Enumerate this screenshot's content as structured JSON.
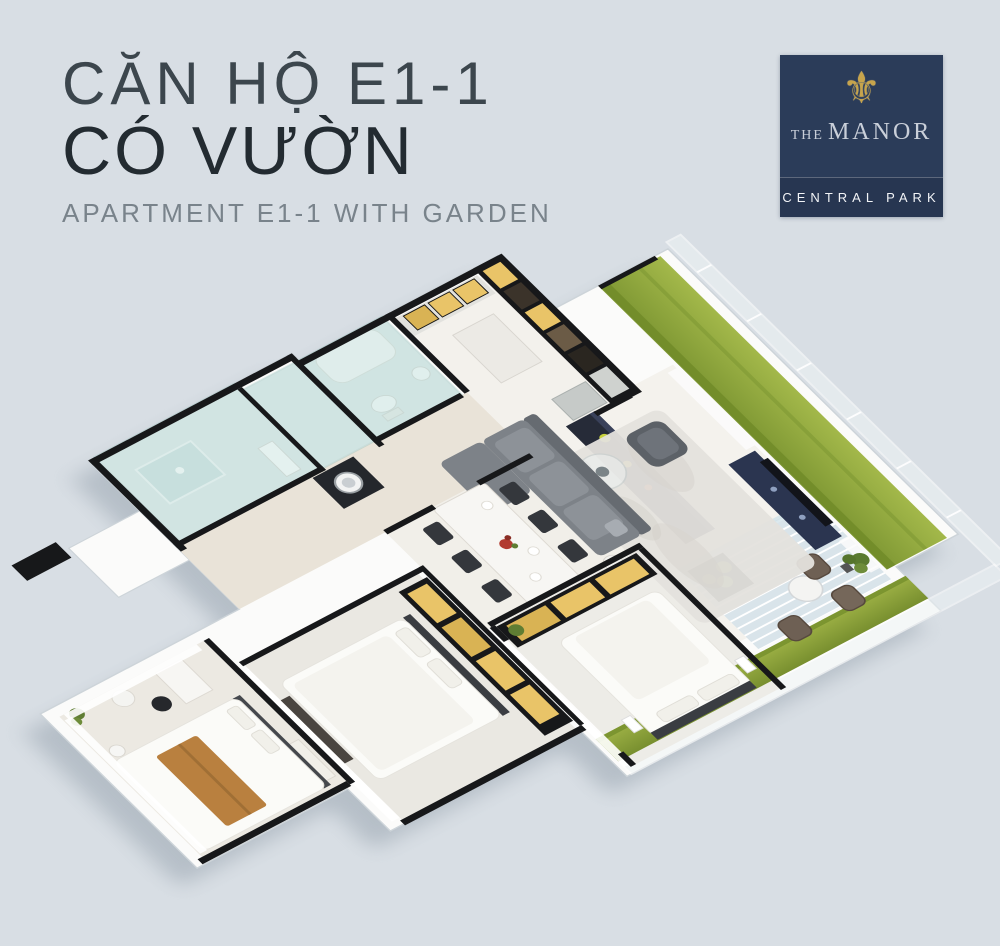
{
  "page": {
    "background": "#d8dee4",
    "width": 1000,
    "height": 946
  },
  "header": {
    "title_line1": "CĂN HỘ E1-1",
    "title_line2": "CÓ VƯỜN",
    "subtitle": "APARTMENT E1-1 WITH GARDEN",
    "colors": {
      "line1": "#3c464d",
      "line2": "#232b31",
      "subtitle": "#79838b"
    }
  },
  "logo": {
    "name_prefix": "THE",
    "name": "MANOR",
    "tagline": "CENTRAL PARK",
    "ornament": "⚜",
    "colors": {
      "background": "#2b3c59",
      "band": "#273651",
      "gold": "#c7a44c",
      "name_text": "#c9cfd9",
      "tagline_text": "#f2f4f7"
    }
  },
  "floor_plan": {
    "description": "3D isometric cutaway rendering of apartment E1-1 with wrap-around garden terrace",
    "areas": [
      "garden-strip",
      "terrace-deck",
      "kitchen",
      "bar-counter",
      "living-room",
      "dining-area",
      "corridor",
      "bathroom-1",
      "bathroom-2",
      "laundry",
      "bedroom-3",
      "bedroom-2",
      "master-bedroom",
      "entry"
    ],
    "colors": {
      "slab_white": "#fbfbfa",
      "slab_edge": "#cdd4d9",
      "wall_dark": "#17181a",
      "grass_light": "#a3b84a",
      "grass_dark": "#7e9733",
      "deck": "#d9e4ea",
      "floor_main": "#f4f2ed",
      "floor_warm": "#e9e3d8",
      "floor_bedroom": "#ece9e2",
      "glass_teal": "#a8d2cd",
      "navy": "#2b3550",
      "sofa_gray": "#7d8288",
      "rug": "#e4e2dd",
      "cabinet_yellow": "#e9c468",
      "bed_white": "#fbfbf8",
      "throw_brown": "#b9803f",
      "chair_dark": "#34373c",
      "outdoor_chair": "#6e6054",
      "plant_green": "#5f7d33",
      "flower_red": "#b23b30",
      "shadow": "#8d9aa6"
    }
  }
}
